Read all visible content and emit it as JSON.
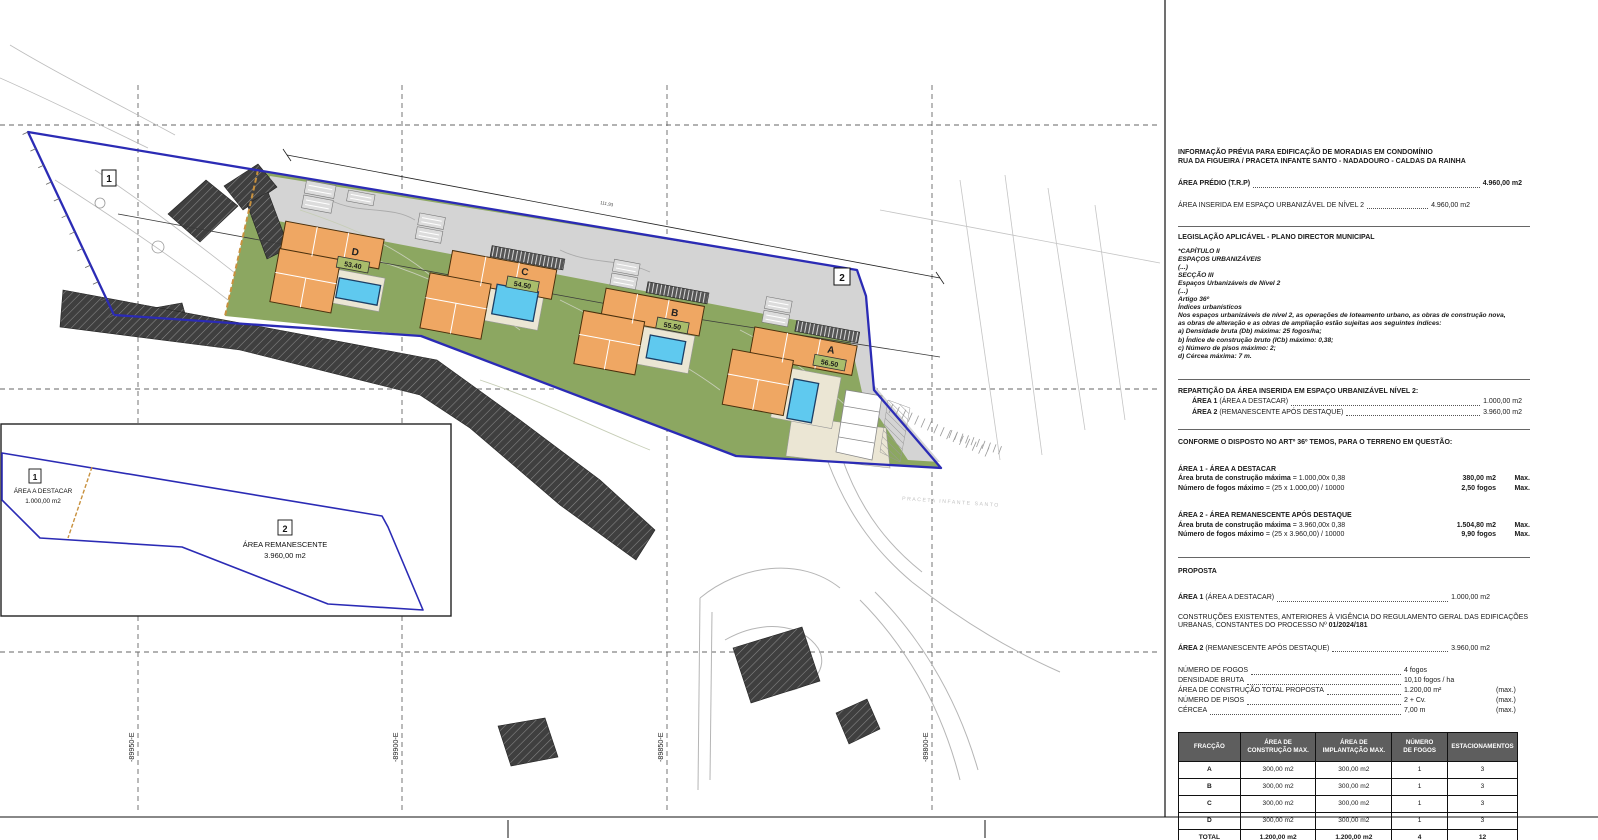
{
  "plan": {
    "grid_x_labels": [
      "-89950-E",
      "-89900-E",
      "-89850-E",
      "-89800-E"
    ],
    "marker_1": "1",
    "marker_2": "2",
    "street_label": "PRACETA INFANTE SANTO",
    "dim_label": "111,93",
    "houses": [
      {
        "id": "D",
        "level": "53.40"
      },
      {
        "id": "C",
        "level": "54.50"
      },
      {
        "id": "B",
        "level": "55.50"
      },
      {
        "id": "A",
        "level": "56.50"
      }
    ],
    "colors": {
      "boundary_blue": "#2B2BB5",
      "lawn_green": "#8CA761",
      "house_orange": "#EFA763",
      "pool_blue": "#5FC9EF",
      "road_gray": "#D4D4D4",
      "patio_cream": "#EBE6D4",
      "hatch_dark": "#3F3F3F",
      "divider_orange": "#C8913E"
    }
  },
  "inset": {
    "area1_marker": "1",
    "area1_label": "ÁREA A DESTACAR",
    "area1_value": "1.000,00 m2",
    "area2_marker": "2",
    "area2_label": "ÁREA REMANESCENTE",
    "area2_value": "3.960,00 m2"
  },
  "panel": {
    "title1": "INFORMAÇÃO PRÉVIA PARA EDIFICAÇÃO DE MORADIAS EM CONDOMÍNIO",
    "title2": "RUA DA FIGUEIRA / PRACETA INFANTE SANTO - NADADOURO - CALDAS DA RAINHA",
    "area_predio_label": "ÁREA PRÉDIO (T.R.P)",
    "area_predio_value": "4.960,00 m2",
    "area_inserida_label": "ÁREA INSERIDA EM ESPAÇO URBANIZÁVEL DE NÍVEL 2",
    "area_inserida_value": "4.960,00 m2",
    "legislacao_title": "LEGISLAÇÃO APLICÁVEL - PLANO DIRECTOR MUNICIPAL",
    "legislacao_lines": [
      "*CAPÍTULO II",
      "ESPAÇOS URBANIZÁVEIS",
      "(...)",
      "SECÇÃO III",
      "Espaços Urbanizáveis de Nível 2",
      "(...)",
      "Artigo 36º",
      "Índices urbanísticos",
      "Nos espaços urbanizáveis de nível 2, as operações de loteamento urbano, as obras de construção nova,",
      "as obras de alteração e as obras de ampliação estão sujeitas aos seguintes índices:",
      "a) Densidade bruta (Db) máxima: 25 fogos/ha;",
      "b) Índice de construção bruto (ICb) máximo: 0,38;",
      "c) Número de pisos máximo: 2;",
      "d) Cércea máxima: 7 m."
    ],
    "reparticao_title": "REPARTIÇÃO DA ÁREA INSERIDA EM ESPAÇO URBANIZÁVEL NÍVEL 2:",
    "reparticao_rows": [
      {
        "label": "ÁREA 1",
        "sub": "(ÁREA A DESTACAR)",
        "value": "1.000,00 m2"
      },
      {
        "label": "ÁREA 2",
        "sub": "(REMANESCENTE APÓS DESTAQUE)",
        "value": "3.960,00 m2"
      }
    ],
    "conforme_title": "CONFORME O DISPOSTO NO ARTº 36º TEMOS, PARA O TERRENO EM QUESTÃO:",
    "area1_block": {
      "title": "ÁREA 1 - ÁREA A DESTACAR",
      "rows": [
        {
          "label": "Área bruta de construção máxima",
          "formula": "= 1.000,00x 0,38",
          "value": "380,00 m2",
          "suffix": "Max."
        },
        {
          "label": "Número de fogos máximo",
          "formula": "= (25 x 1.000,00) / 10000",
          "value": "2,50 fogos",
          "suffix": "Max."
        }
      ]
    },
    "area2_block": {
      "title": "ÁREA 2 - ÁREA REMANESCENTE APÓS DESTAQUE",
      "rows": [
        {
          "label": "Área bruta de construção máxima",
          "formula": "= 3.960,00x 0,38",
          "value": "1.504,80 m2",
          "suffix": "Max."
        },
        {
          "label": "Número de fogos máximo",
          "formula": "= (25 x 3.960,00) / 10000",
          "value": "9,90 fogos",
          "suffix": "Max."
        }
      ]
    },
    "proposta_title": "PROPOSTA",
    "proposta_area1_label": "ÁREA 1",
    "proposta_area1_sub": "(ÁREA A DESTACAR)",
    "proposta_area1_value": "1.000,00 m2",
    "construcoes_line1": "CONSTRUÇÕES EXISTENTES, ANTERIORES À VIGÊNCIA DO REGULAMENTO GERAL DAS EDIFICAÇÕES",
    "construcoes_line2_prefix": "URBANAS, CONSTANTES DO PROCESSO Nº ",
    "construcoes_process": "01/2024/181",
    "proposta_area2_label": "ÁREA 2",
    "proposta_area2_sub": "(REMANESCENTE APÓS DESTAQUE)",
    "proposta_area2_value": "3.960,00 m2",
    "proposal_rows": [
      {
        "label": "NÚMERO DE FOGOS",
        "value": "4 fogos",
        "suffix": ""
      },
      {
        "label": "DENSIDADE BRUTA",
        "value": "10,10 fogos / ha",
        "suffix": ""
      },
      {
        "label": "ÁREA DE CONSTRUÇÃO TOTAL PROPOSTA",
        "value": "1.200,00 m²",
        "suffix": "(max.)"
      },
      {
        "label": "NÚMERO DE PISOS",
        "value": "2 + Cv.",
        "suffix": "(max.)"
      },
      {
        "label": "CÉRCEA",
        "value": "7,00 m",
        "suffix": "(max.)"
      }
    ],
    "table": {
      "headers": [
        [
          "FRACÇÃO"
        ],
        [
          "ÁREA DE",
          "CONSTRUÇÃO MAX."
        ],
        [
          "ÁREA DE",
          "IMPLANTAÇÃO MAX."
        ],
        [
          "NÚMERO",
          "DE FOGOS"
        ],
        [
          "ESTACIONAMENTOS"
        ]
      ],
      "rows": [
        [
          "A",
          "300,00 m2",
          "300,00 m2",
          "1",
          "3"
        ],
        [
          "B",
          "300,00 m2",
          "300,00 m2",
          "1",
          "3"
        ],
        [
          "C",
          "300,00 m2",
          "300,00 m2",
          "1",
          "3"
        ],
        [
          "D",
          "300,00 m2",
          "300,00 m2",
          "1",
          "3"
        ]
      ],
      "total": [
        "TOTAL",
        "1.200,00 m2",
        "1.200,00 m2",
        "4",
        "12"
      ]
    }
  }
}
